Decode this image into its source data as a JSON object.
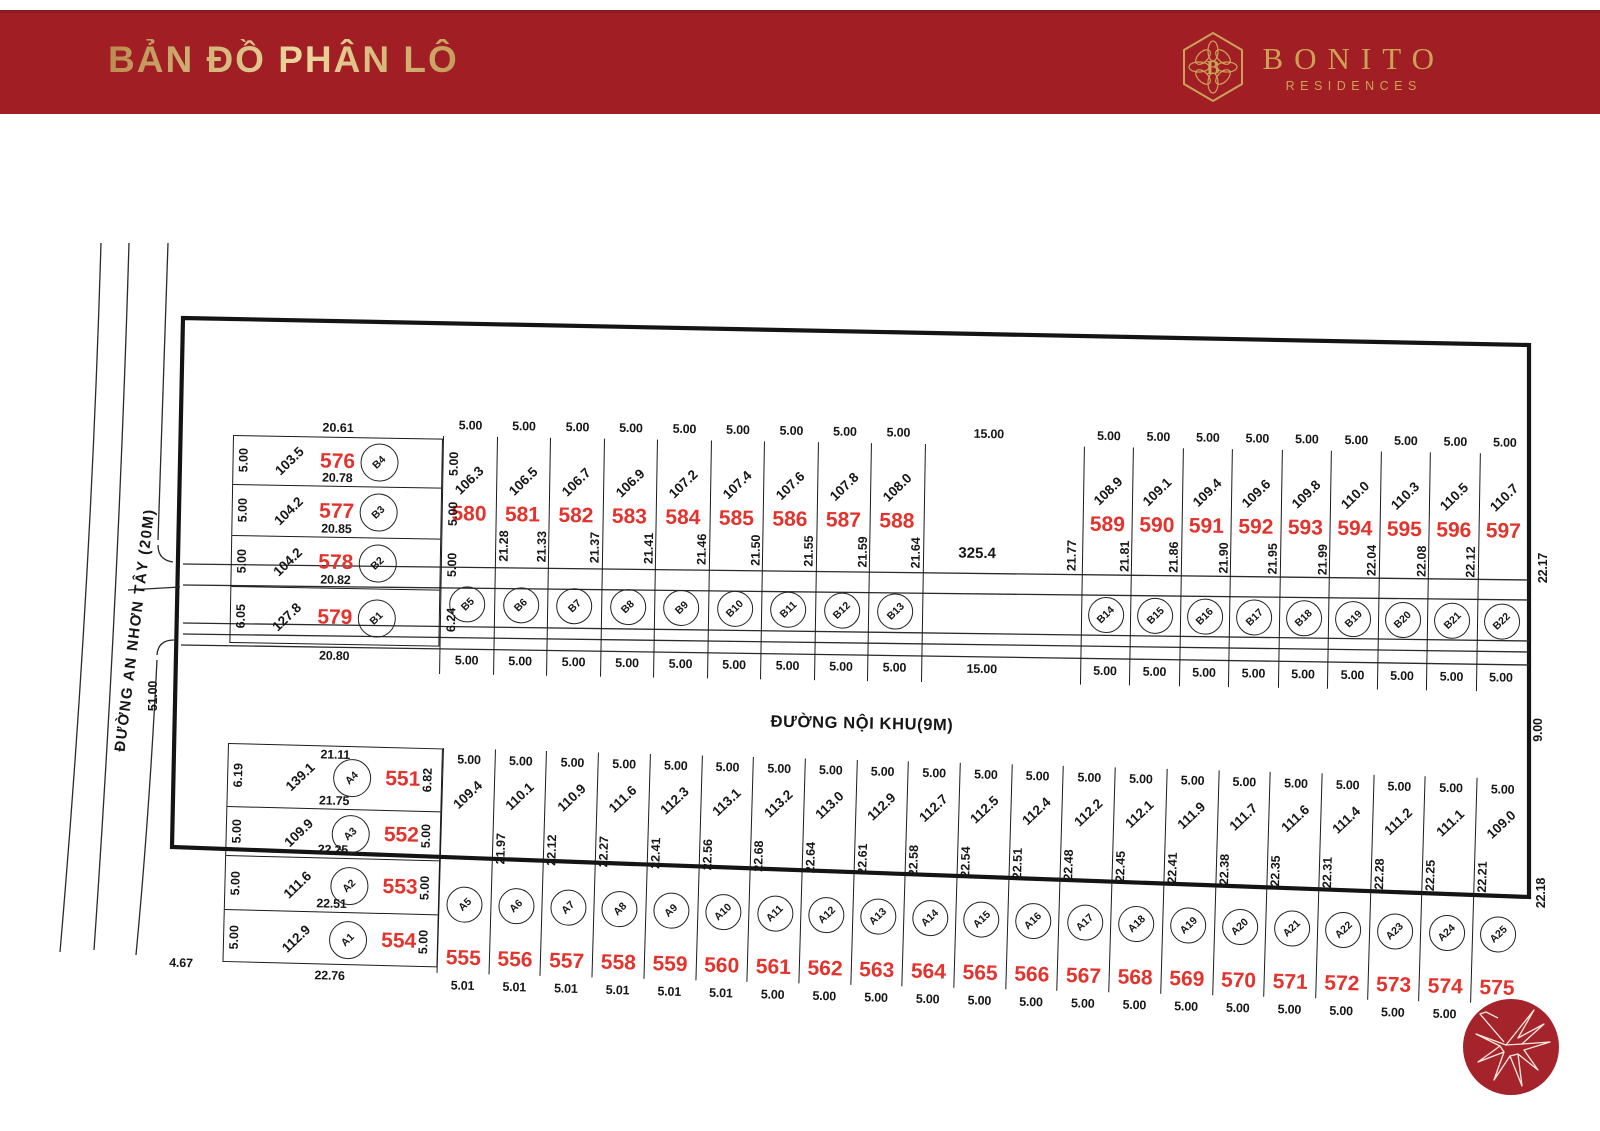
{
  "header": {
    "title": "BẢN ĐỒ PHÂN LÔ",
    "brand_monogram": "B",
    "brand_name": "BONITO",
    "brand_sub": "RESIDENCES"
  },
  "roads": {
    "left_name": "ĐƯỜNG AN NHƠN TÂY (20M)",
    "internal_name": "ĐƯỜNG NỘI KHU(9M)"
  },
  "edge_dims": {
    "left_frontage": "51.00",
    "right_top_depth": "22.17",
    "right_road_width": "9.00",
    "right_bottom_depth": "22.18",
    "bottom_left": "4.67"
  },
  "blocks": {
    "b_left": {
      "top_dim": "20.61",
      "lots": [
        {
          "no": "576",
          "circle": "B4",
          "area": "103.5",
          "left": "5.00",
          "right": "5.00",
          "bottom": "20.78"
        },
        {
          "no": "577",
          "circle": "B3",
          "area": "104.2",
          "left": "5.00",
          "right": "5.00",
          "bottom": "20.85"
        },
        {
          "no": "578",
          "circle": "B2",
          "area": "104.2",
          "left": "5.00",
          "right": "5.00",
          "bottom": "20.82"
        },
        {
          "no": "579",
          "circle": "B1",
          "area": "127.8",
          "left": "6.05",
          "right": "6.24",
          "bottom": "20.80"
        }
      ]
    },
    "b_west": [
      {
        "no": "580",
        "circle": "B5",
        "area": "106.3",
        "top": "5.00",
        "bottom": "5.00"
      },
      {
        "no": "581",
        "circle": "B6",
        "area": "106.5",
        "top": "5.00",
        "bottom": "5.00",
        "depth_left": "21.28",
        "depth_right": "21.33"
      },
      {
        "no": "582",
        "circle": "B7",
        "area": "106.7",
        "top": "5.00",
        "bottom": "5.00",
        "depth_right": "21.37"
      },
      {
        "no": "583",
        "circle": "B8",
        "area": "106.9",
        "top": "5.00",
        "bottom": "5.00",
        "depth_right": "21.41"
      },
      {
        "no": "584",
        "circle": "B9",
        "area": "107.2",
        "top": "5.00",
        "bottom": "5.00",
        "depth_right": "21.46"
      },
      {
        "no": "585",
        "circle": "B10",
        "area": "107.4",
        "top": "5.00",
        "bottom": "5.00",
        "depth_right": "21.50"
      },
      {
        "no": "586",
        "circle": "B11",
        "area": "107.6",
        "top": "5.00",
        "bottom": "5.00",
        "depth_right": "21.55"
      },
      {
        "no": "587",
        "circle": "B12",
        "area": "107.8",
        "top": "5.00",
        "bottom": "5.00",
        "depth_right": "21.59"
      },
      {
        "no": "588",
        "circle": "B13",
        "area": "108.0",
        "top": "5.00",
        "bottom": "5.00",
        "depth_right": "21.64"
      }
    ],
    "big": {
      "area": "325.4",
      "top": "15.00",
      "bottom": "15.00",
      "depth_right": "21.77"
    },
    "b_east": [
      {
        "no": "589",
        "circle": "B14",
        "area": "108.9",
        "top": "5.00",
        "bottom": "5.00",
        "depth_right": "21.81"
      },
      {
        "no": "590",
        "circle": "B15",
        "area": "109.1",
        "top": "5.00",
        "bottom": "5.00",
        "depth_right": "21.86"
      },
      {
        "no": "591",
        "circle": "B16",
        "area": "109.4",
        "top": "5.00",
        "bottom": "5.00",
        "depth_right": "21.90"
      },
      {
        "no": "592",
        "circle": "B17",
        "area": "109.6",
        "top": "5.00",
        "bottom": "5.00",
        "depth_right": "21.95"
      },
      {
        "no": "593",
        "circle": "B18",
        "area": "109.8",
        "top": "5.00",
        "bottom": "5.00",
        "depth_right": "21.99"
      },
      {
        "no": "594",
        "circle": "B19",
        "area": "110.0",
        "top": "5.00",
        "bottom": "5.00",
        "depth_right": "22.04"
      },
      {
        "no": "595",
        "circle": "B20",
        "area": "110.3",
        "top": "5.00",
        "bottom": "5.00",
        "depth_right": "22.08"
      },
      {
        "no": "596",
        "circle": "B21",
        "area": "110.5",
        "top": "5.00",
        "bottom": "5.00",
        "depth_right": "22.12"
      },
      {
        "no": "597",
        "circle": "B22",
        "area": "110.7",
        "top": "5.00",
        "bottom": "5.00"
      }
    ],
    "a_left": {
      "lots": [
        {
          "no": "551",
          "circle": "A4",
          "area": "139.1",
          "left": "6.19",
          "right": "6.82",
          "top": "21.11",
          "bottom": "21.75"
        },
        {
          "no": "552",
          "circle": "A3",
          "area": "109.9",
          "left": "5.00",
          "right": "5.00",
          "bottom": "22.25"
        },
        {
          "no": "553",
          "circle": "A2",
          "area": "111.6",
          "left": "5.00",
          "right": "5.00",
          "bottom": "22.51"
        },
        {
          "no": "554",
          "circle": "A1",
          "area": "112.9",
          "left": "5.00",
          "right": "5.00",
          "bottom": "22.76"
        }
      ]
    },
    "a_strip": [
      {
        "no": "555",
        "circle": "A5",
        "area": "109.4",
        "top": "5.00",
        "bottom": "5.01"
      },
      {
        "no": "556",
        "circle": "A6",
        "area": "110.1",
        "top": "5.00",
        "bottom": "5.01",
        "depth_left": "21.97"
      },
      {
        "no": "557",
        "circle": "A7",
        "area": "110.9",
        "top": "5.00",
        "bottom": "5.01",
        "depth_left": "22.12"
      },
      {
        "no": "558",
        "circle": "A8",
        "area": "111.6",
        "top": "5.00",
        "bottom": "5.01",
        "depth_left": "22.27"
      },
      {
        "no": "559",
        "circle": "A9",
        "area": "112.3",
        "top": "5.00",
        "bottom": "5.01",
        "depth_left": "22.41"
      },
      {
        "no": "560",
        "circle": "A10",
        "area": "113.1",
        "top": "5.00",
        "bottom": "5.01",
        "depth_left": "22.56"
      },
      {
        "no": "561",
        "circle": "A11",
        "area": "113.2",
        "top": "5.00",
        "bottom": "5.00",
        "depth_left": "22.68"
      },
      {
        "no": "562",
        "circle": "A12",
        "area": "113.0",
        "top": "5.00",
        "bottom": "5.00",
        "depth_left": "22.64"
      },
      {
        "no": "563",
        "circle": "A13",
        "area": "112.9",
        "top": "5.00",
        "bottom": "5.00",
        "depth_left": "22.61"
      },
      {
        "no": "564",
        "circle": "A14",
        "area": "112.7",
        "top": "5.00",
        "bottom": "5.00",
        "depth_left": "22.58"
      },
      {
        "no": "565",
        "circle": "A15",
        "area": "112.5",
        "top": "5.00",
        "bottom": "5.00",
        "depth_left": "22.54"
      },
      {
        "no": "566",
        "circle": "A16",
        "area": "112.4",
        "top": "5.00",
        "bottom": "5.00",
        "depth_left": "22.51"
      },
      {
        "no": "567",
        "circle": "A17",
        "area": "112.2",
        "top": "5.00",
        "bottom": "5.00",
        "depth_left": "22.48"
      },
      {
        "no": "568",
        "circle": "A18",
        "area": "112.1",
        "top": "5.00",
        "bottom": "5.00",
        "depth_left": "22.45"
      },
      {
        "no": "569",
        "circle": "A19",
        "area": "111.9",
        "top": "5.00",
        "bottom": "5.00",
        "depth_left": "22.41"
      },
      {
        "no": "570",
        "circle": "A20",
        "area": "111.7",
        "top": "5.00",
        "bottom": "5.00",
        "depth_left": "22.38"
      },
      {
        "no": "571",
        "circle": "A21",
        "area": "111.6",
        "top": "5.00",
        "bottom": "5.00",
        "depth_left": "22.35"
      },
      {
        "no": "572",
        "circle": "A22",
        "area": "111.4",
        "top": "5.00",
        "bottom": "5.00",
        "depth_left": "22.31"
      },
      {
        "no": "573",
        "circle": "A23",
        "area": "111.2",
        "top": "5.00",
        "bottom": "5.00",
        "depth_left": "22.28"
      },
      {
        "no": "574",
        "circle": "A24",
        "area": "111.1",
        "top": "5.00",
        "bottom": "5.00",
        "depth_left": "22.25"
      },
      {
        "no": "575",
        "circle": "A25",
        "area": "109.0",
        "top": "5.00",
        "bottom": "5.00",
        "depth_left": "22.21"
      }
    ]
  },
  "colors": {
    "header_red": "#a01e24",
    "gold": "#cda258",
    "lot_number_red": "#e4332d",
    "line": "#1b1b1b",
    "compass_red": "#a5242c"
  }
}
